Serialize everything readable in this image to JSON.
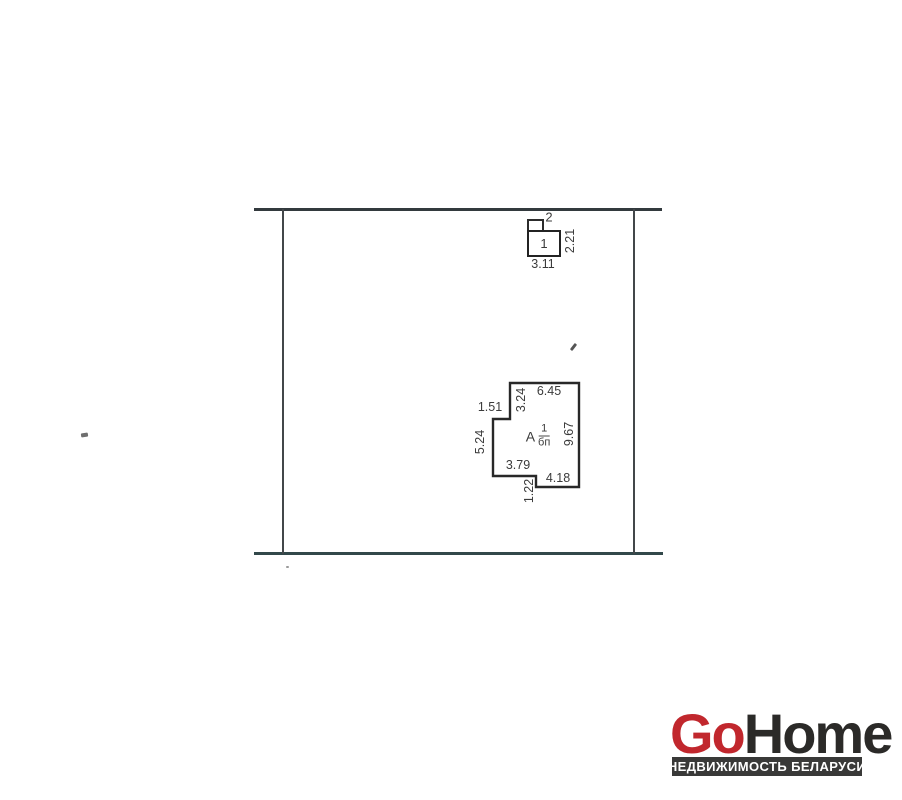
{
  "plan": {
    "outbuilding": {
      "annex_label": "2",
      "main_label": "1",
      "dim_width": "3.11",
      "dim_height": "2.21"
    },
    "house": {
      "letter": "А",
      "floors": "1",
      "material": "бп",
      "dims": {
        "top": "6.45",
        "inner_top_vertical": "3.24",
        "notch_horizontal": "1.51",
        "left_vertical": "5.24",
        "right_vertical": "9.67",
        "bottom_left": "3.79",
        "bottom_right": "4.18",
        "bottom_step_vertical": "1.22"
      }
    }
  },
  "logo": {
    "brand_go": "Go",
    "brand_home": "Home",
    "tagline": "НЕДВИЖИМОСТЬ БЕЛАРУСИ"
  },
  "colors": {
    "brand_red": "#c1272d",
    "brand_dark": "#2b2a28",
    "tagline_bg": "#393938",
    "plan_line": "#3a4144"
  }
}
